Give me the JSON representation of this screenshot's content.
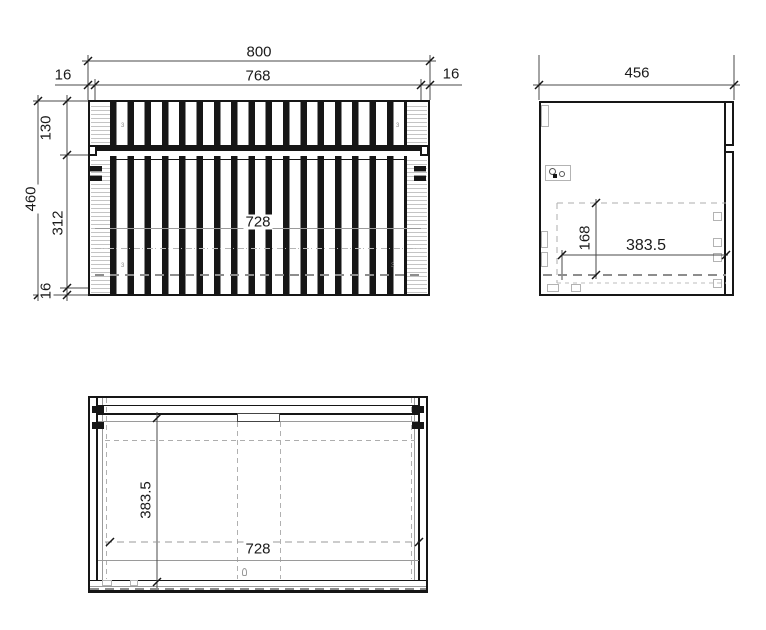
{
  "sheet": {
    "background": "#ffffff",
    "line_color": "#161616",
    "dashed_line_color": "#9a9a9a"
  },
  "front_view": {
    "dims": {
      "overall_width": "800",
      "front_panel_width": "768",
      "gap_left": "16",
      "gap_right": "16",
      "overall_height": "460",
      "drawer_front_height": "130",
      "door_front_height": "312",
      "bottom_offset": "16",
      "carcass_inner_width": "728"
    },
    "tiny_mark": "3"
  },
  "side_view": {
    "dims": {
      "overall_depth": "456",
      "inner_height": "168",
      "inner_depth": "383.5"
    }
  },
  "plan_view": {
    "dims": {
      "inner_depth": "383.5",
      "carcass_inner_width": "728"
    }
  }
}
